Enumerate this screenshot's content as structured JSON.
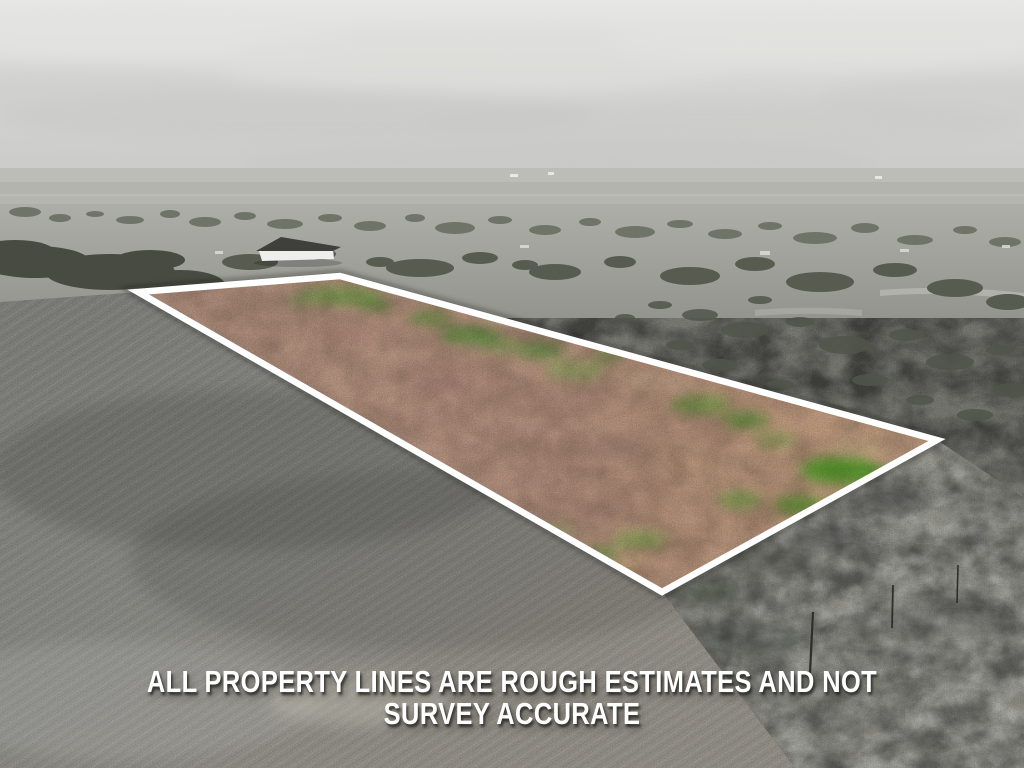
{
  "photo": {
    "description": "Aerial drone photo of flat rural acreage; the listed parcel is shown in natural color (pink-tan soil with green growth) outlined by a white boundary line, while all surrounding land — plowed field, scrub brush, distant homes and overcast sky — is desaturated to grayscale.",
    "palette": {
      "sky": "#d6d6d4",
      "distant_fields": "#bdbdb8",
      "scrubland": "#7d7d77",
      "plowed_field": "#8d8d88",
      "tree_canopy": "#51554a",
      "parcel_soil_pink": "#b8937f",
      "parcel_soil_tan": "#c7a586",
      "parcel_grass_green": "#68a03e",
      "boundary_line": "#ffffff"
    }
  },
  "disclaimer": {
    "line1": "ALL PROPERTY LINES ARE ROUGH ESTIMATES AND NOT",
    "line2": "SURVEY ACCURATE",
    "color": "#ffffff"
  }
}
